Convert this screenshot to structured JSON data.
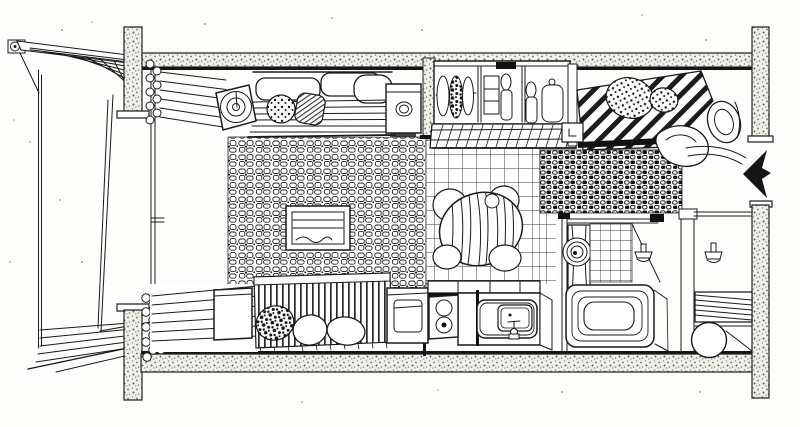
{
  "scene": {
    "description": "Hand-drawn pen-and-ink axonometric floor plan of a compact studio apartment",
    "style": "pen-and-ink sketch, black line art on white paper",
    "colors": {
      "paper": "#fdfdfb",
      "ink": "#1a1a1a",
      "wall_speckle": "#f0efea",
      "arrow": "#161616"
    },
    "rooms": [
      "balcony",
      "living-area",
      "wardrobe-closet",
      "sleeping-area",
      "dining-nook",
      "kitchenette",
      "bathroom",
      "entry-hall"
    ],
    "furniture": [
      "sofa-with-cushions",
      "spiral-lamp-end-table",
      "side-cabinet-with-bowl",
      "hanging-clothes-wardrobe",
      "striped-double-bed",
      "day-bed-with-pillows",
      "cube-stool",
      "round-dining-table",
      "dining-chairs",
      "tv-low-table",
      "kitchen-sink",
      "two-burner-stove",
      "under-counter-appliance",
      "washing-machine",
      "bathtub",
      "wall-faucets",
      "slatted-bench",
      "round-stool",
      "curtains",
      "area-rugs"
    ],
    "entrance_arrow_direction": "left"
  }
}
